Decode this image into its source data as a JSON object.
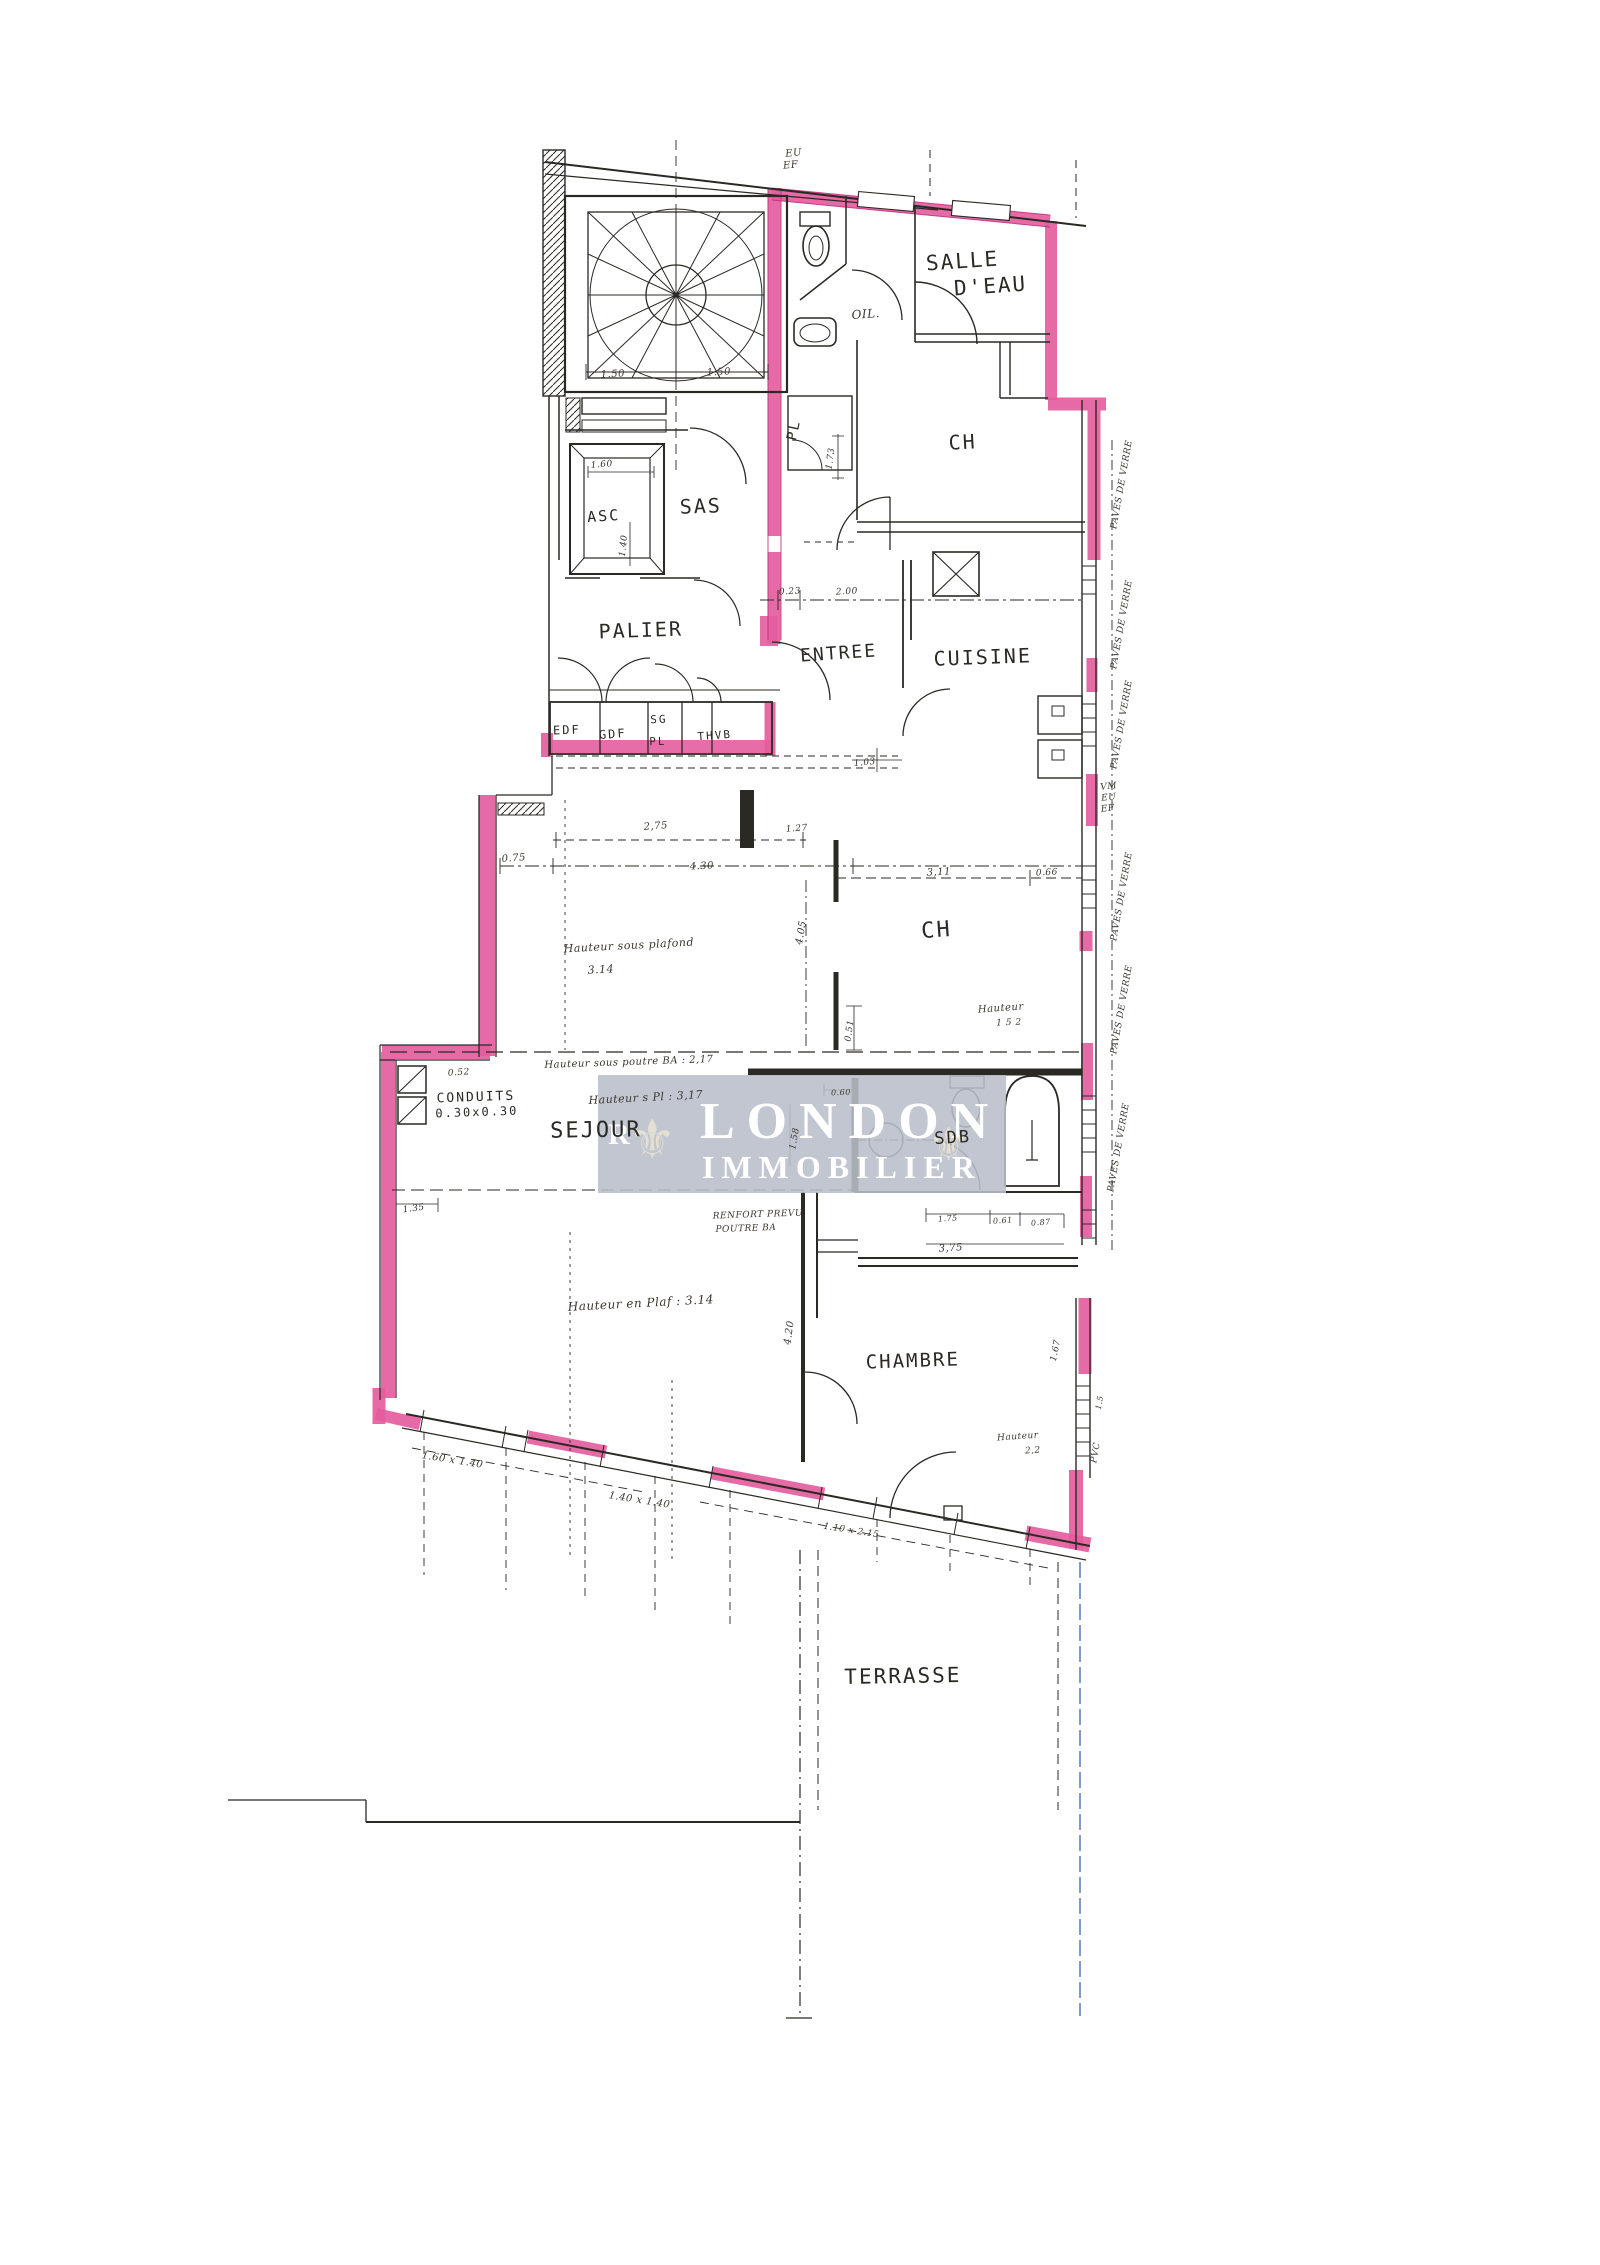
{
  "document": {
    "kind": "scanned apartment floor plan",
    "language": "fr"
  },
  "colors": {
    "paper": "#ffffff",
    "ink": "#2b2923",
    "hand_ink": "#3a372e",
    "wall_highlight": "#e45d9e",
    "wall_highlight_deep": "#c22a7e",
    "watermark_bg": "#b8bec9",
    "watermark_text": "#ffffff",
    "terrace_blue_line": "#7d9cc9"
  },
  "watermark": {
    "line1": "LONDON",
    "line2": "IMMOBILIER",
    "fleur": "⚜",
    "edge_letter": "R"
  },
  "rooms": [
    "SALLE D'EAU",
    "CH",
    "SAS",
    "ASC",
    "PALIER",
    "ENTREE",
    "CUISINE",
    "CH",
    "SEJOUR",
    "SDB",
    "CHAMBRE",
    "TERRASSE"
  ],
  "labels": [
    {
      "name": "note-eu-top",
      "text": "EU",
      "x": 794,
      "y": 156,
      "size": 10,
      "rot": -6,
      "st": "hand"
    },
    {
      "name": "note-ef-top",
      "text": "EF",
      "x": 791,
      "y": 168,
      "size": 10,
      "rot": -6,
      "st": "hand"
    },
    {
      "name": "room-salle-deau-line1",
      "text": "SALLE",
      "x": 963,
      "y": 268,
      "size": 21,
      "rot": -4,
      "st": "print"
    },
    {
      "name": "room-salle-deau-line2",
      "text": "D'EAU",
      "x": 991,
      "y": 293,
      "size": 21,
      "rot": -4,
      "st": "print"
    },
    {
      "name": "note-oil",
      "text": "OIL.",
      "x": 866,
      "y": 318,
      "size": 12,
      "rot": -4,
      "st": "hand"
    },
    {
      "name": "room-ch-top",
      "text": "CH",
      "x": 963,
      "y": 449,
      "size": 20,
      "rot": -3,
      "st": "print"
    },
    {
      "name": "label-pl-vertical",
      "text": "PL",
      "x": 798,
      "y": 431,
      "size": 14,
      "rot": -78,
      "st": "print"
    },
    {
      "name": "dim-150-a",
      "text": "1.50",
      "x": 613,
      "y": 377,
      "size": 10,
      "rot": -3,
      "st": "hand"
    },
    {
      "name": "dim-150-b",
      "text": "1.50",
      "x": 719,
      "y": 375,
      "size": 10,
      "rot": -3,
      "st": "hand"
    },
    {
      "name": "dim-160",
      "text": "1.60",
      "x": 602,
      "y": 467,
      "size": 9,
      "rot": -5,
      "st": "hand"
    },
    {
      "name": "room-asc",
      "text": "ASC",
      "x": 604,
      "y": 521,
      "size": 15,
      "rot": -4,
      "st": "print"
    },
    {
      "name": "room-sas",
      "text": "SAS",
      "x": 701,
      "y": 513,
      "size": 20,
      "rot": -2,
      "st": "print"
    },
    {
      "name": "dim-140",
      "text": "1.40",
      "x": 626,
      "y": 546,
      "size": 9,
      "rot": -84,
      "st": "hand"
    },
    {
      "name": "dim-173",
      "text": "1.73",
      "x": 833,
      "y": 459,
      "size": 9,
      "rot": -82,
      "st": "hand"
    },
    {
      "name": "room-palier",
      "text": "PALIER",
      "x": 641,
      "y": 637,
      "size": 20,
      "rot": -2,
      "st": "print"
    },
    {
      "name": "room-entree",
      "text": "ENTREE",
      "x": 839,
      "y": 659,
      "size": 18,
      "rot": -4,
      "st": "print"
    },
    {
      "name": "room-cuisine",
      "text": "CUISINE",
      "x": 983,
      "y": 664,
      "size": 20,
      "rot": -2,
      "st": "print"
    },
    {
      "name": "dim-023",
      "text": "0.23",
      "x": 790,
      "y": 594,
      "size": 9,
      "rot": -3,
      "st": "hand"
    },
    {
      "name": "dim-200",
      "text": "2.00",
      "x": 847,
      "y": 594,
      "size": 9,
      "rot": -3,
      "st": "hand"
    },
    {
      "name": "closet-edf",
      "text": "EDF",
      "x": 567,
      "y": 734,
      "size": 12,
      "rot": -2,
      "st": "print"
    },
    {
      "name": "closet-gdf",
      "text": "GDF",
      "x": 613,
      "y": 738,
      "size": 12,
      "rot": -4,
      "st": "print"
    },
    {
      "name": "closet-sg",
      "text": "SG",
      "x": 659,
      "y": 723,
      "size": 11,
      "rot": -2,
      "st": "print"
    },
    {
      "name": "closet-pl",
      "text": "PL",
      "x": 658,
      "y": 745,
      "size": 11,
      "rot": -2,
      "st": "print"
    },
    {
      "name": "closet-thvb",
      "text": "THVB",
      "x": 715,
      "y": 739,
      "size": 11,
      "rot": -4,
      "st": "print"
    },
    {
      "name": "dim-103",
      "text": "1.03",
      "x": 865,
      "y": 765,
      "size": 9,
      "rot": -6,
      "st": "hand"
    },
    {
      "name": "note-vm",
      "text": "VM",
      "x": 1109,
      "y": 789,
      "size": 9,
      "rot": -6,
      "st": "hand"
    },
    {
      "name": "note-eu-2",
      "text": "EU",
      "x": 1109,
      "y": 800,
      "size": 9,
      "rot": -6,
      "st": "hand"
    },
    {
      "name": "note-ef-2",
      "text": "EF",
      "x": 1108,
      "y": 811,
      "size": 9,
      "rot": -6,
      "st": "hand"
    },
    {
      "name": "note-paves-1",
      "text": "PAVES DE VERRE",
      "x": 1124,
      "y": 485,
      "size": 9,
      "rot": -80,
      "st": "hand"
    },
    {
      "name": "note-paves-2",
      "text": "PAVES DE VERRE",
      "x": 1124,
      "y": 625,
      "size": 9,
      "rot": -80,
      "st": "hand"
    },
    {
      "name": "note-paves-3",
      "text": "PAVES DE VERRE",
      "x": 1124,
      "y": 725,
      "size": 9,
      "rot": -80,
      "st": "hand"
    },
    {
      "name": "note-paves-4",
      "text": "PAVES DE VERRE",
      "x": 1124,
      "y": 897,
      "size": 9,
      "rot": -80,
      "st": "hand"
    },
    {
      "name": "note-paves-5",
      "text": "PAVES DE VERRE",
      "x": 1124,
      "y": 1010,
      "size": 9,
      "rot": -80,
      "st": "hand"
    },
    {
      "name": "note-paves-6",
      "text": "PAVES DE VERRE",
      "x": 1121,
      "y": 1148,
      "size": 9,
      "rot": -80,
      "st": "hand"
    },
    {
      "name": "dim-275",
      "text": "2,75",
      "x": 656,
      "y": 829,
      "size": 10,
      "rot": -4,
      "st": "hand"
    },
    {
      "name": "dim-127",
      "text": "1.27",
      "x": 797,
      "y": 831,
      "size": 9,
      "rot": -4,
      "st": "hand"
    },
    {
      "name": "dim-075",
      "text": "0.75",
      "x": 514,
      "y": 861,
      "size": 10,
      "rot": -4,
      "st": "hand"
    },
    {
      "name": "dim-430",
      "text": "4.30",
      "x": 702,
      "y": 869,
      "size": 10,
      "rot": -3,
      "st": "hand"
    },
    {
      "name": "dim-311",
      "text": "3,11",
      "x": 939,
      "y": 875,
      "size": 10,
      "rot": -3,
      "st": "hand"
    },
    {
      "name": "dim-066",
      "text": "0.66",
      "x": 1047,
      "y": 875,
      "size": 9,
      "rot": -3,
      "st": "hand"
    },
    {
      "name": "dim-405",
      "text": "4.05",
      "x": 804,
      "y": 933,
      "size": 10,
      "rot": -80,
      "st": "hand"
    },
    {
      "name": "note-hauteur-plafond-1",
      "text": "Hauteur sous plafond",
      "x": 629,
      "y": 949,
      "size": 11,
      "rot": -3,
      "st": "hand"
    },
    {
      "name": "note-hauteur-plafond-2",
      "text": "3.14",
      "x": 601,
      "y": 973,
      "size": 11,
      "rot": -3,
      "st": "hand"
    },
    {
      "name": "room-ch-mid",
      "text": "CH",
      "x": 937,
      "y": 937,
      "size": 22,
      "rot": -4,
      "st": "print"
    },
    {
      "name": "note-hauteur-152-1",
      "text": "Hauteur",
      "x": 1001,
      "y": 1011,
      "size": 10,
      "rot": -4,
      "st": "hand"
    },
    {
      "name": "note-hauteur-152-2",
      "text": "1 5 2",
      "x": 1009,
      "y": 1025,
      "size": 9,
      "rot": -2,
      "st": "hand"
    },
    {
      "name": "dim-051",
      "text": "0.51",
      "x": 852,
      "y": 1031,
      "size": 9,
      "rot": -82,
      "st": "hand"
    },
    {
      "name": "note-poutre-ba",
      "text": "Hauteur sous poutre BA : 2,17",
      "x": 629,
      "y": 1065,
      "size": 10,
      "rot": -2,
      "st": "hand"
    },
    {
      "name": "dim-052",
      "text": "0.52",
      "x": 459,
      "y": 1075,
      "size": 9,
      "rot": -4,
      "st": "hand"
    },
    {
      "name": "note-hauteur-pl",
      "text": "Hauteur s Pl : 3,17",
      "x": 646,
      "y": 1101,
      "size": 11,
      "rot": -3,
      "st": "hand"
    },
    {
      "name": "label-conduits-1",
      "text": "CONDUITS",
      "x": 476,
      "y": 1101,
      "size": 13,
      "rot": -2,
      "st": "print"
    },
    {
      "name": "label-conduits-2",
      "text": "0.30x0.30",
      "x": 477,
      "y": 1116,
      "size": 12,
      "rot": -2,
      "st": "print"
    },
    {
      "name": "dim-060",
      "text": "0.60",
      "x": 841,
      "y": 1095,
      "size": 8,
      "rot": -2,
      "st": "hand"
    },
    {
      "name": "dim-158",
      "text": "1.58",
      "x": 797,
      "y": 1139,
      "size": 9,
      "rot": -80,
      "st": "hand"
    },
    {
      "name": "room-sejour",
      "text": "SEJOUR",
      "x": 596,
      "y": 1137,
      "size": 22,
      "rot": -1,
      "st": "print"
    },
    {
      "name": "room-sdb",
      "text": "SDB",
      "x": 953,
      "y": 1143,
      "size": 17,
      "rot": -3,
      "st": "print"
    },
    {
      "name": "dim-135",
      "text": "1.35",
      "x": 414,
      "y": 1211,
      "size": 9,
      "rot": -8,
      "st": "hand"
    },
    {
      "name": "note-renfort-1",
      "text": "RENFORT PREVU",
      "x": 758,
      "y": 1217,
      "size": 9,
      "rot": -2,
      "st": "hand"
    },
    {
      "name": "note-renfort-2",
      "text": "POUTRE BA",
      "x": 746,
      "y": 1231,
      "size": 9,
      "rot": -2,
      "st": "hand"
    },
    {
      "name": "dim-175",
      "text": "1.75",
      "x": 948,
      "y": 1221,
      "size": 8,
      "rot": -4,
      "st": "hand"
    },
    {
      "name": "dim-061",
      "text": "0.61",
      "x": 1003,
      "y": 1223,
      "size": 8,
      "rot": -4,
      "st": "hand"
    },
    {
      "name": "dim-087",
      "text": "0.87",
      "x": 1041,
      "y": 1225,
      "size": 8,
      "rot": -4,
      "st": "hand"
    },
    {
      "name": "dim-375",
      "text": "3,75",
      "x": 951,
      "y": 1251,
      "size": 10,
      "rot": -4,
      "st": "hand"
    },
    {
      "name": "note-hauteur-plaf",
      "text": "Hauteur en Plaf : 3.14",
      "x": 641,
      "y": 1307,
      "size": 12,
      "rot": -3,
      "st": "hand"
    },
    {
      "name": "dim-420",
      "text": "4.20",
      "x": 792,
      "y": 1333,
      "size": 10,
      "rot": -82,
      "st": "hand"
    },
    {
      "name": "dim-167",
      "text": "1.67",
      "x": 1058,
      "y": 1351,
      "size": 9,
      "rot": -78,
      "st": "hand"
    },
    {
      "name": "dim-15",
      "text": "1.5",
      "x": 1102,
      "y": 1403,
      "size": 8,
      "rot": -80,
      "st": "hand"
    },
    {
      "name": "room-chambre",
      "text": "CHAMBRE",
      "x": 913,
      "y": 1367,
      "size": 19,
      "rot": -2,
      "st": "print"
    },
    {
      "name": "note-hauteur-chambre-1",
      "text": "Hauteur",
      "x": 1018,
      "y": 1439,
      "size": 9,
      "rot": -4,
      "st": "hand"
    },
    {
      "name": "note-hauteur-chambre-2",
      "text": "2,2",
      "x": 1033,
      "y": 1453,
      "size": 9,
      "rot": -4,
      "st": "hand"
    },
    {
      "name": "note-pvc",
      "text": "PVC",
      "x": 1098,
      "y": 1453,
      "size": 9,
      "rot": -80,
      "st": "hand"
    },
    {
      "name": "dim-window-1",
      "text": "1.60 x 1.40",
      "x": 452,
      "y": 1463,
      "size": 10,
      "rot": 9,
      "st": "hand"
    },
    {
      "name": "dim-window-2",
      "text": "1.40 x 1.40",
      "x": 639,
      "y": 1503,
      "size": 10,
      "rot": 9,
      "st": "hand"
    },
    {
      "name": "dim-window-3",
      "text": "1.10 x 2.15",
      "x": 851,
      "y": 1533,
      "size": 9,
      "rot": 9,
      "st": "hand"
    },
    {
      "name": "room-terrasse",
      "text": "TERRASSE",
      "x": 903,
      "y": 1683,
      "size": 21,
      "rot": -1,
      "st": "print"
    }
  ]
}
